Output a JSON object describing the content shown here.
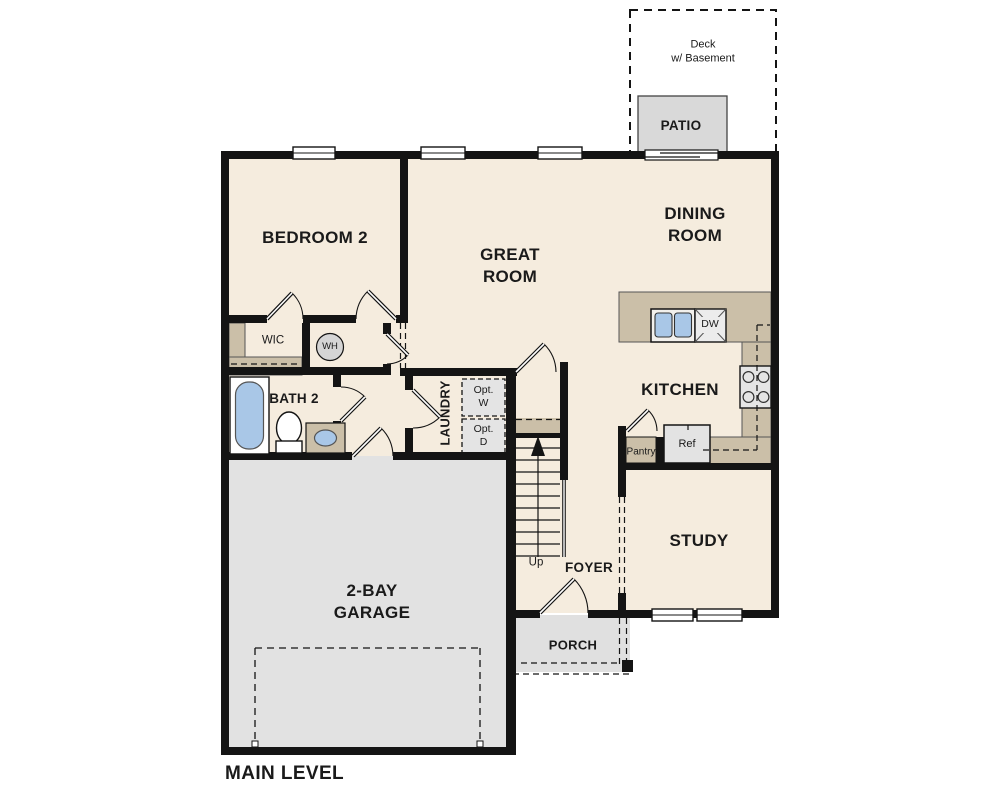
{
  "plan": {
    "title": "MAIN LEVEL",
    "colors": {
      "wall": "#141414",
      "floor": "#f5ecde",
      "counter": "#cbbfa8",
      "garage_floor": "#e2e2e2",
      "porch_floor": "#e0e0e0",
      "patio_floor": "#d9d9d9",
      "fixture_blue": "#a9c7e7",
      "appliance_gray": "#e5e5e5",
      "optional_gray": "#e4e4e4"
    },
    "labels": {
      "deck": "Deck\nw/ Basement",
      "patio": "PATIO",
      "bedroom2": "BEDROOM 2",
      "great_room": "GREAT\nROOM",
      "dining_room": "DINING\nROOM",
      "wic": "WIC",
      "water_heater": "WH",
      "bath2": "BATH 2",
      "laundry": "LAUNDRY",
      "opt_washer": "Opt.\nW",
      "opt_dryer": "Opt.\nD",
      "kitchen": "KITCHEN",
      "dishwasher": "DW",
      "pantry": "Pantry",
      "refrigerator": "Ref",
      "study": "STUDY",
      "up": "Up",
      "foyer": "FOYER",
      "garage": "2-BAY\nGARAGE",
      "porch": "PORCH",
      "main_level": "MAIN LEVEL"
    }
  }
}
